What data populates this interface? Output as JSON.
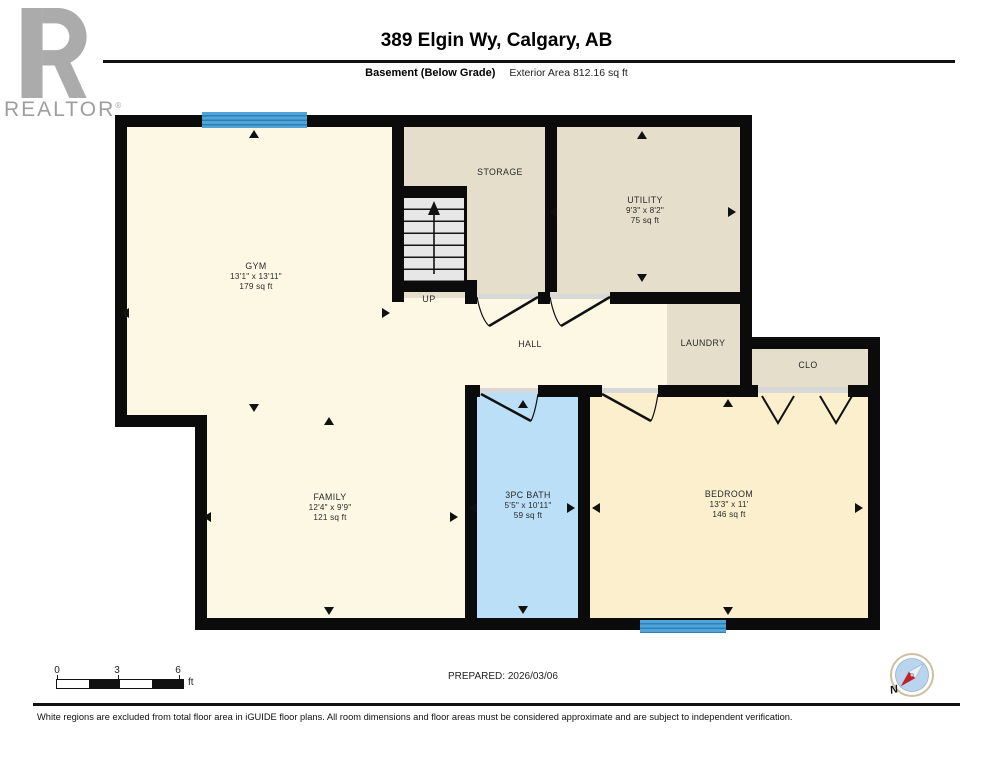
{
  "colors": {
    "wall": "#0B0B0B",
    "cream": "#FDF8E4",
    "tan": "#E5DECA",
    "bath_blue": "#BADFF7",
    "bedroom_cream": "#FBEFCD",
    "window_blue": "#4FA5DA",
    "window_stripe": "#2E7FAF",
    "stair_gray": "#E7E7E7",
    "sill_gray": "#D8D8D8",
    "logo_gray": "#ABABAB",
    "compass_ring": "#CDC09E",
    "compass_face": "#B9D4EC",
    "compass_red": "#C32026"
  },
  "header": {
    "logo_wordmark": "REALTOR",
    "logo_registered": "®",
    "title": "389 Elgin Wy, Calgary, AB",
    "floor_label": "Basement (Below Grade)",
    "area_label": "Exterior Area 812.16 sq ft"
  },
  "plan": {
    "rooms": {
      "gym": {
        "name": "GYM",
        "dims": "13'1\" x 13'11\"",
        "area": "179 sq ft"
      },
      "storage": {
        "name": "STORAGE"
      },
      "utility": {
        "name": "UTILITY",
        "dims": "9'3\" x 8'2\"",
        "area": "75 sq ft"
      },
      "hall": {
        "name": "HALL"
      },
      "laundry": {
        "name": "LAUNDRY"
      },
      "closet": {
        "name": "CLO"
      },
      "family": {
        "name": "FAMILY",
        "dims": "12'4\" x 9'9\"",
        "area": "121 sq ft"
      },
      "bath": {
        "name": "3PC BATH",
        "dims": "5'5\" x 10'11\"",
        "area": "59 sq ft"
      },
      "bedroom": {
        "name": "BEDROOM",
        "dims": "13'3\" x 11'",
        "area": "146 sq ft"
      }
    },
    "stairs_label": "UP",
    "dimension_arrows": [
      {
        "x": 249,
        "y": 130,
        "dir": "up"
      },
      {
        "x": 121,
        "y": 308,
        "dir": "left"
      },
      {
        "x": 382,
        "y": 308,
        "dir": "right"
      },
      {
        "x": 249,
        "y": 404,
        "dir": "down"
      },
      {
        "x": 324,
        "y": 417,
        "dir": "up"
      },
      {
        "x": 203,
        "y": 512,
        "dir": "left"
      },
      {
        "x": 450,
        "y": 512,
        "dir": "right"
      },
      {
        "x": 324,
        "y": 607,
        "dir": "down"
      },
      {
        "x": 637,
        "y": 131,
        "dir": "up"
      },
      {
        "x": 549,
        "y": 207,
        "dir": "left"
      },
      {
        "x": 728,
        "y": 207,
        "dir": "right"
      },
      {
        "x": 637,
        "y": 274,
        "dir": "down"
      },
      {
        "x": 518,
        "y": 400,
        "dir": "up"
      },
      {
        "x": 469,
        "y": 503,
        "dir": "left"
      },
      {
        "x": 567,
        "y": 503,
        "dir": "right"
      },
      {
        "x": 518,
        "y": 606,
        "dir": "down"
      },
      {
        "x": 723,
        "y": 399,
        "dir": "up"
      },
      {
        "x": 592,
        "y": 503,
        "dir": "left"
      },
      {
        "x": 855,
        "y": 503,
        "dir": "right"
      },
      {
        "x": 723,
        "y": 607,
        "dir": "down"
      }
    ]
  },
  "footer": {
    "scale_ticks": [
      "0",
      "3",
      "6"
    ],
    "scale_unit": "ft",
    "prepared": "PREPARED: 2026/03/06",
    "compass_label": "N",
    "disclaimer": "White regions are excluded from total floor area in iGUIDE floor plans. All room dimensions and floor areas must be considered approximate and are subject to independent verification."
  }
}
